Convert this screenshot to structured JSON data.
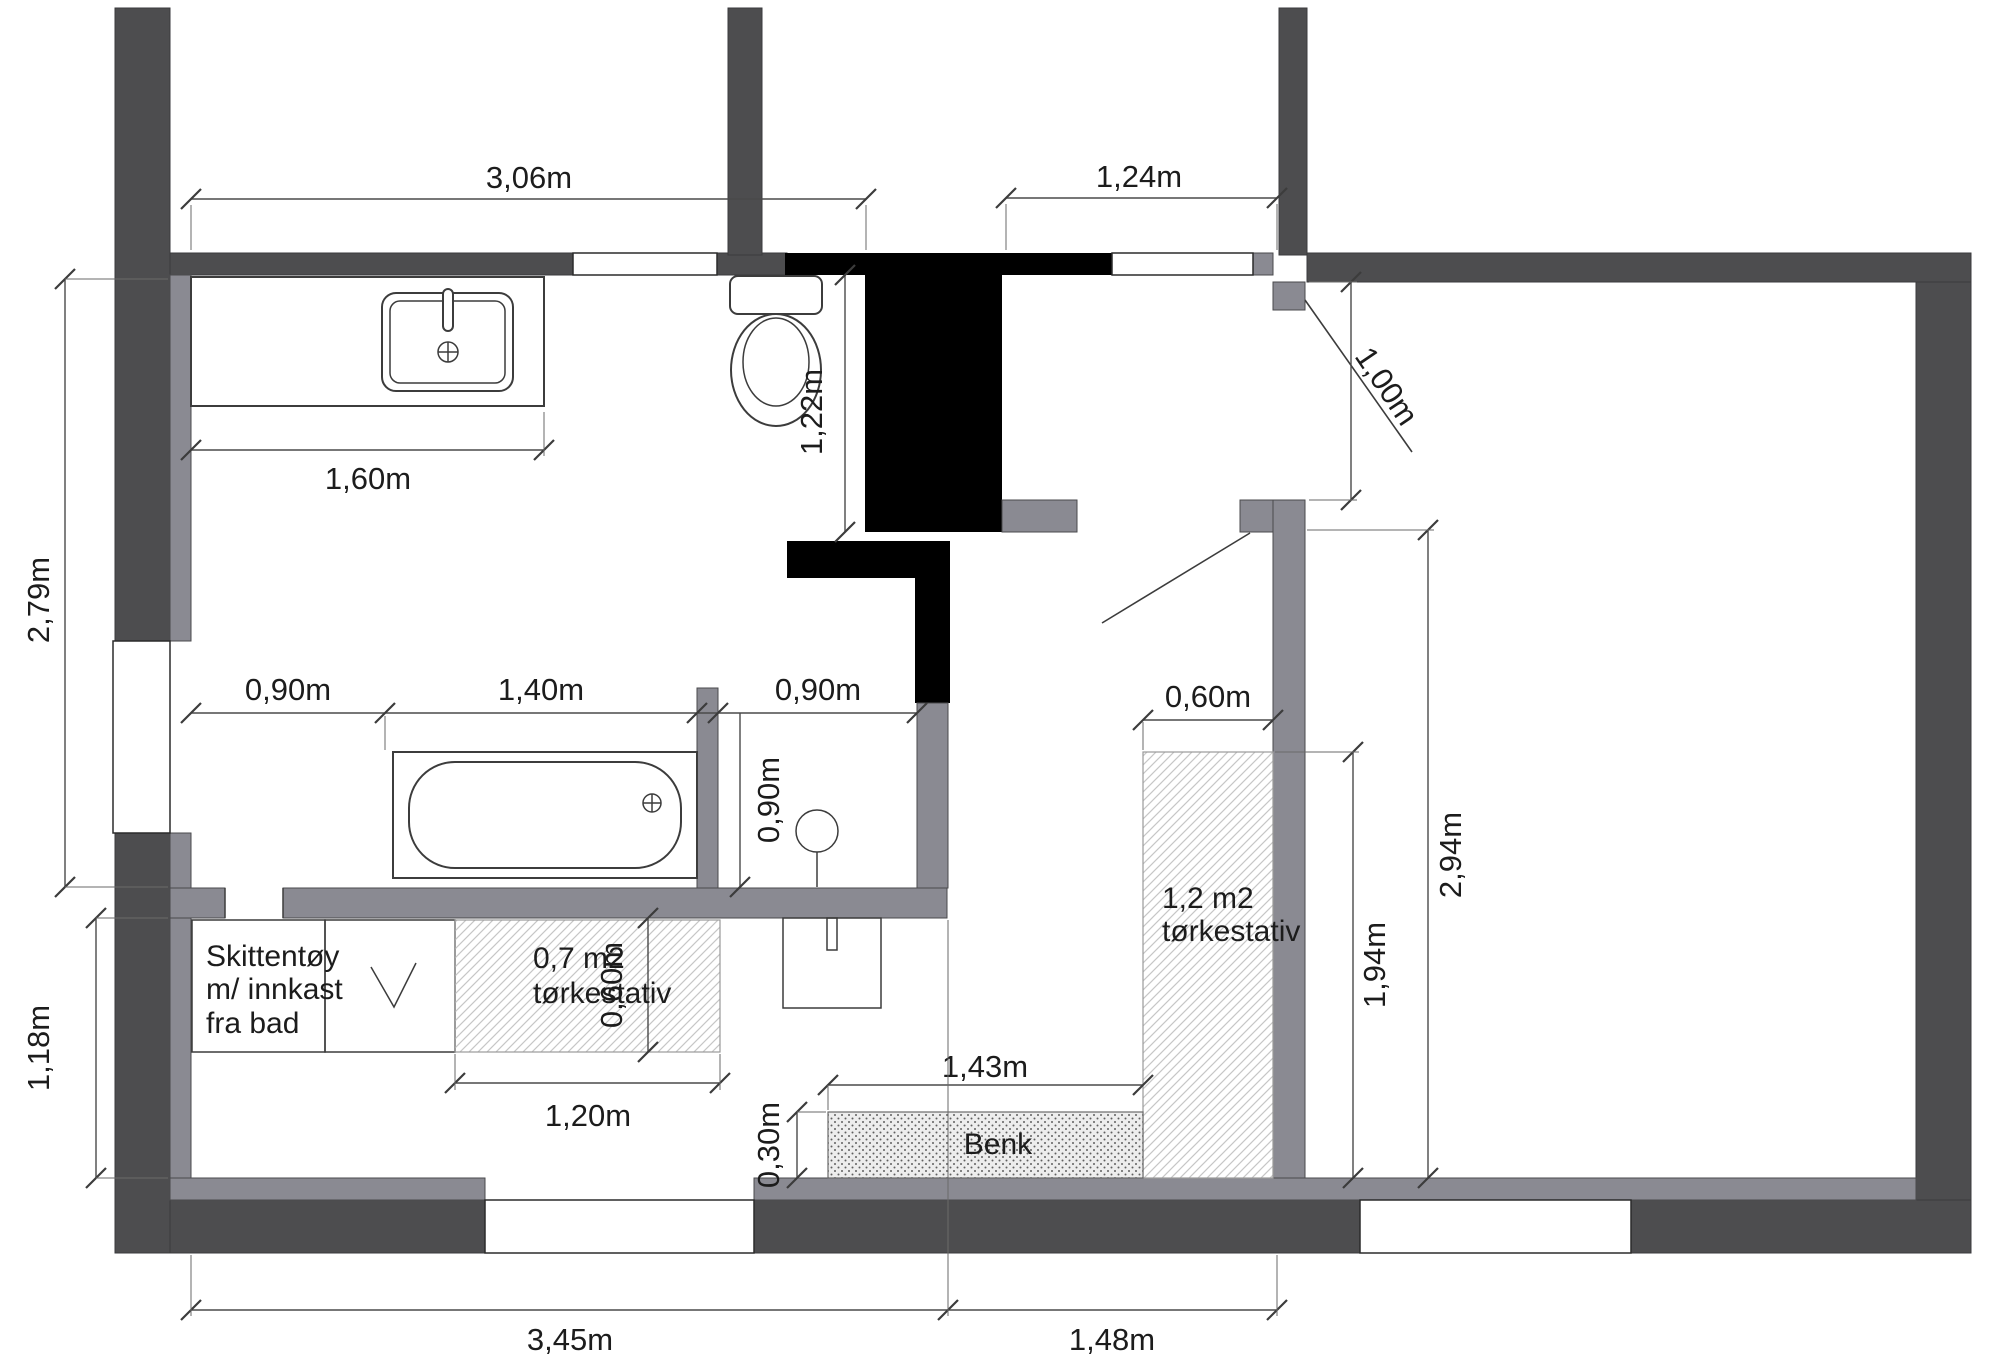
{
  "plan": {
    "title": "floor-plan-bathroom-laundry",
    "dimensions": {
      "top_left_width": "3,06m",
      "top_right_width": "1,24m",
      "vanity_width": "1,60m",
      "bathroom_height": "2,79m",
      "toilet_recess_depth": "1,22m",
      "closet_door_width": "1,00m",
      "row_left": "0,90m",
      "row_tub": "1,40m",
      "nook_width": "0,90m",
      "nook_depth": "0,90m",
      "laundry_height": "1,18m",
      "rack_small_height": "0,60m",
      "rack_small_width": "1,20m",
      "rack_large_width": "0,60m",
      "rack_large_height": "1,94m",
      "hall_height": "2,94m",
      "bench_width": "1,43m",
      "bench_depth": "0,30m",
      "bottom_left_width": "3,45m",
      "bottom_right_width": "1,48m"
    },
    "labels": {
      "laundry_box_line1": "Skittentøy",
      "laundry_box_line2": "m/ innkast",
      "laundry_box_line3": "fra bad",
      "rack_small_line1": "0,7 m2",
      "rack_small_line2": "tørkestativ",
      "rack_large_line1": "1,2 m2",
      "rack_large_line2": "tørkestativ",
      "bench": "Benk"
    },
    "colors": {
      "wall_dark": "#4d4d4f",
      "wall_gray": "#8a8a92",
      "chimney_black": "#000000",
      "background": "#ffffff"
    }
  }
}
